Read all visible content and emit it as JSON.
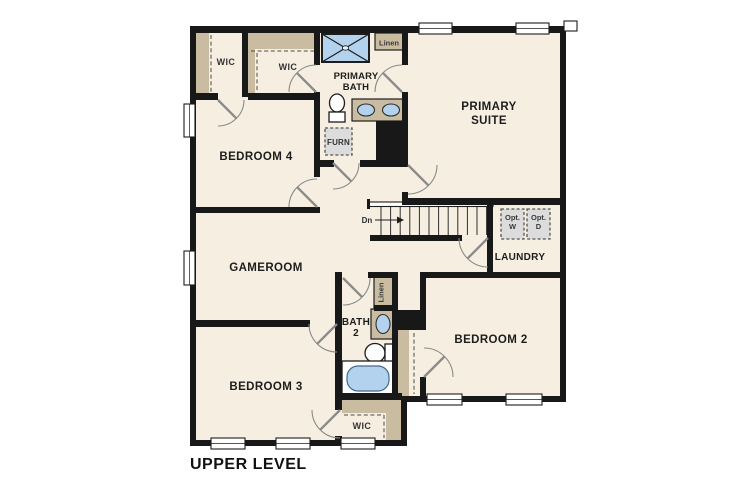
{
  "colors": {
    "floor": "#f6efe1",
    "wall": "#181818",
    "shelf": "#cabca1",
    "water": "#b3d2ed",
    "appliance": "#dcdcdc",
    "door": "#8a8a8a",
    "text": "#1d1d1d"
  },
  "plan": {
    "title": "UPPER LEVEL",
    "rooms": {
      "primary_suite": {
        "line1": "PRIMARY",
        "line2": "SUITE"
      },
      "primary_bath": {
        "line1": "PRIMARY",
        "line2": "BATH"
      },
      "bedroom4": {
        "label": "BEDROOM 4"
      },
      "gameroom": {
        "label": "GAMEROOM"
      },
      "bedroom3": {
        "label": "BEDROOM 3"
      },
      "bedroom2": {
        "label": "BEDROOM 2"
      },
      "laundry": {
        "label": "LAUNDRY"
      },
      "bath2": {
        "line1": "BATH",
        "line2": "2"
      }
    },
    "closets": {
      "wic_bedroom4": "WIC",
      "wic_primary": "WIC",
      "wic_bedroom3": "WIC",
      "linen_primary": "Linen",
      "linen_bath2": "Linen"
    },
    "annotations": {
      "stairs_down": "Dn",
      "furnace": "FURN",
      "opt_washer_line1": "Opt.",
      "opt_washer_line2": "W",
      "opt_dryer_line1": "Opt.",
      "opt_dryer_line2": "D"
    }
  }
}
